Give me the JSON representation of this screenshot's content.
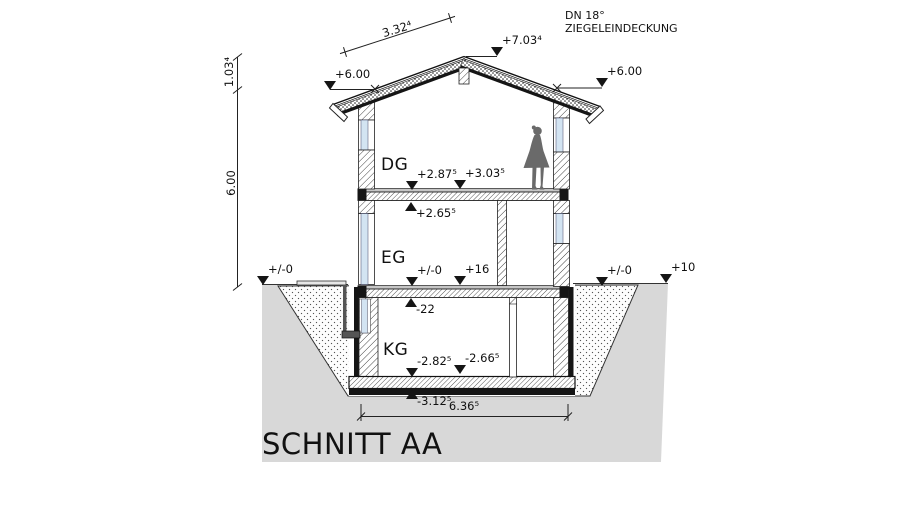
{
  "drawing": {
    "title": "SCHNITT AA",
    "roof_note_line1": "DN 18°",
    "roof_note_line2": "ZIEGELEINDECKUNG"
  },
  "floor_labels": {
    "dg": "DG",
    "eg": "EG",
    "kg": "KG"
  },
  "dimensions": {
    "roof_slope": "3.32⁴",
    "ridge_to_eave": "1.03⁴",
    "eave_to_ground": "6.00",
    "basement_width": "6.36⁵"
  },
  "levels": {
    "eave_left": "+6.00",
    "ridge": "+7.03⁴",
    "eave_right": "+6.00",
    "ground_left": "+/-0",
    "dg_floor_a": "+2.87⁵",
    "dg_floor_b": "+3.03⁵",
    "dg_soffit": "+2.65⁵",
    "eg_floor_a": "+/-0",
    "eg_floor_b": "+16",
    "eg_soffit": "-22",
    "kg_floor_a": "-2.82⁵",
    "kg_floor_b": "-2.66⁵",
    "kg_soffit": "-3.12⁵",
    "ground_right": "+/-0",
    "terrain_right": "+10"
  },
  "colors": {
    "ground": "#d8d8d8",
    "window": "#d3e4f2",
    "figure": "#6a6a6a",
    "ink": "#1a1a1a"
  }
}
